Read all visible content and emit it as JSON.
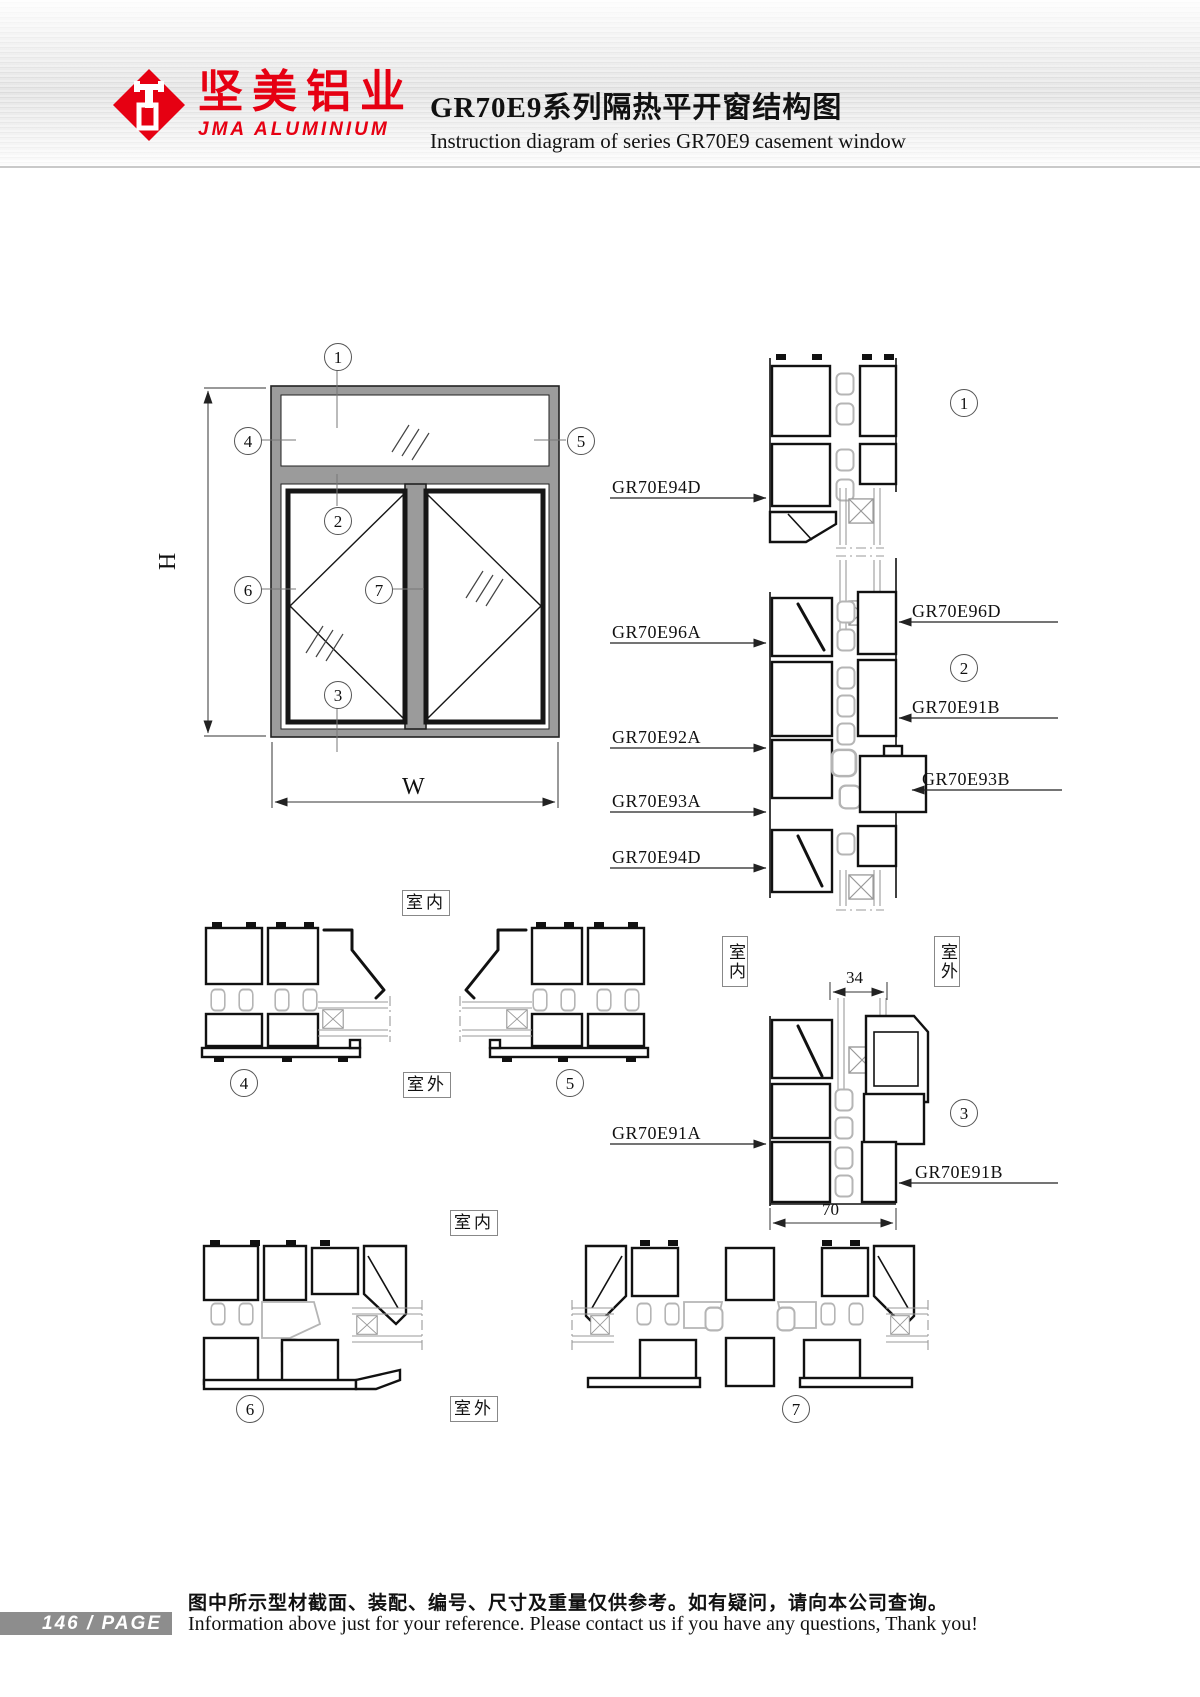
{
  "header": {
    "logo_cn": "坚美铝业",
    "logo_en": "JMA ALUMINIUM",
    "title_cn": "GR70E9系列隔热平开窗结构图",
    "title_en": "Instruction diagram of series GR70E9 casement window"
  },
  "dims": {
    "h": "H",
    "w": "W",
    "d34": "34",
    "d70": "70"
  },
  "callouts": {
    "c1": "1",
    "c2": "2",
    "c3": "3",
    "c4": "4",
    "c5": "5",
    "c6": "6",
    "c7": "7"
  },
  "room": {
    "indoor": "室内",
    "outdoor": "室外"
  },
  "part_labels": {
    "l1": "GR70E94D",
    "l2": "GR70E96A",
    "l3": "GR70E92A",
    "l4": "GR70E93A",
    "l5": "GR70E94D",
    "l6": "GR70E91A",
    "r1": "GR70E96D",
    "r2": "GR70E91B",
    "r3": "GR70E93B",
    "r4": "GR70E91B"
  },
  "footer": {
    "page_text": "146 / PAGE",
    "note_cn": "图中所示型材截面、装配、编号、尺寸及重量仅供参考。如有疑问，请向本公司查询。",
    "note_en": "Information above just for your reference. Please contact us if you have any questions, Thank you!"
  }
}
